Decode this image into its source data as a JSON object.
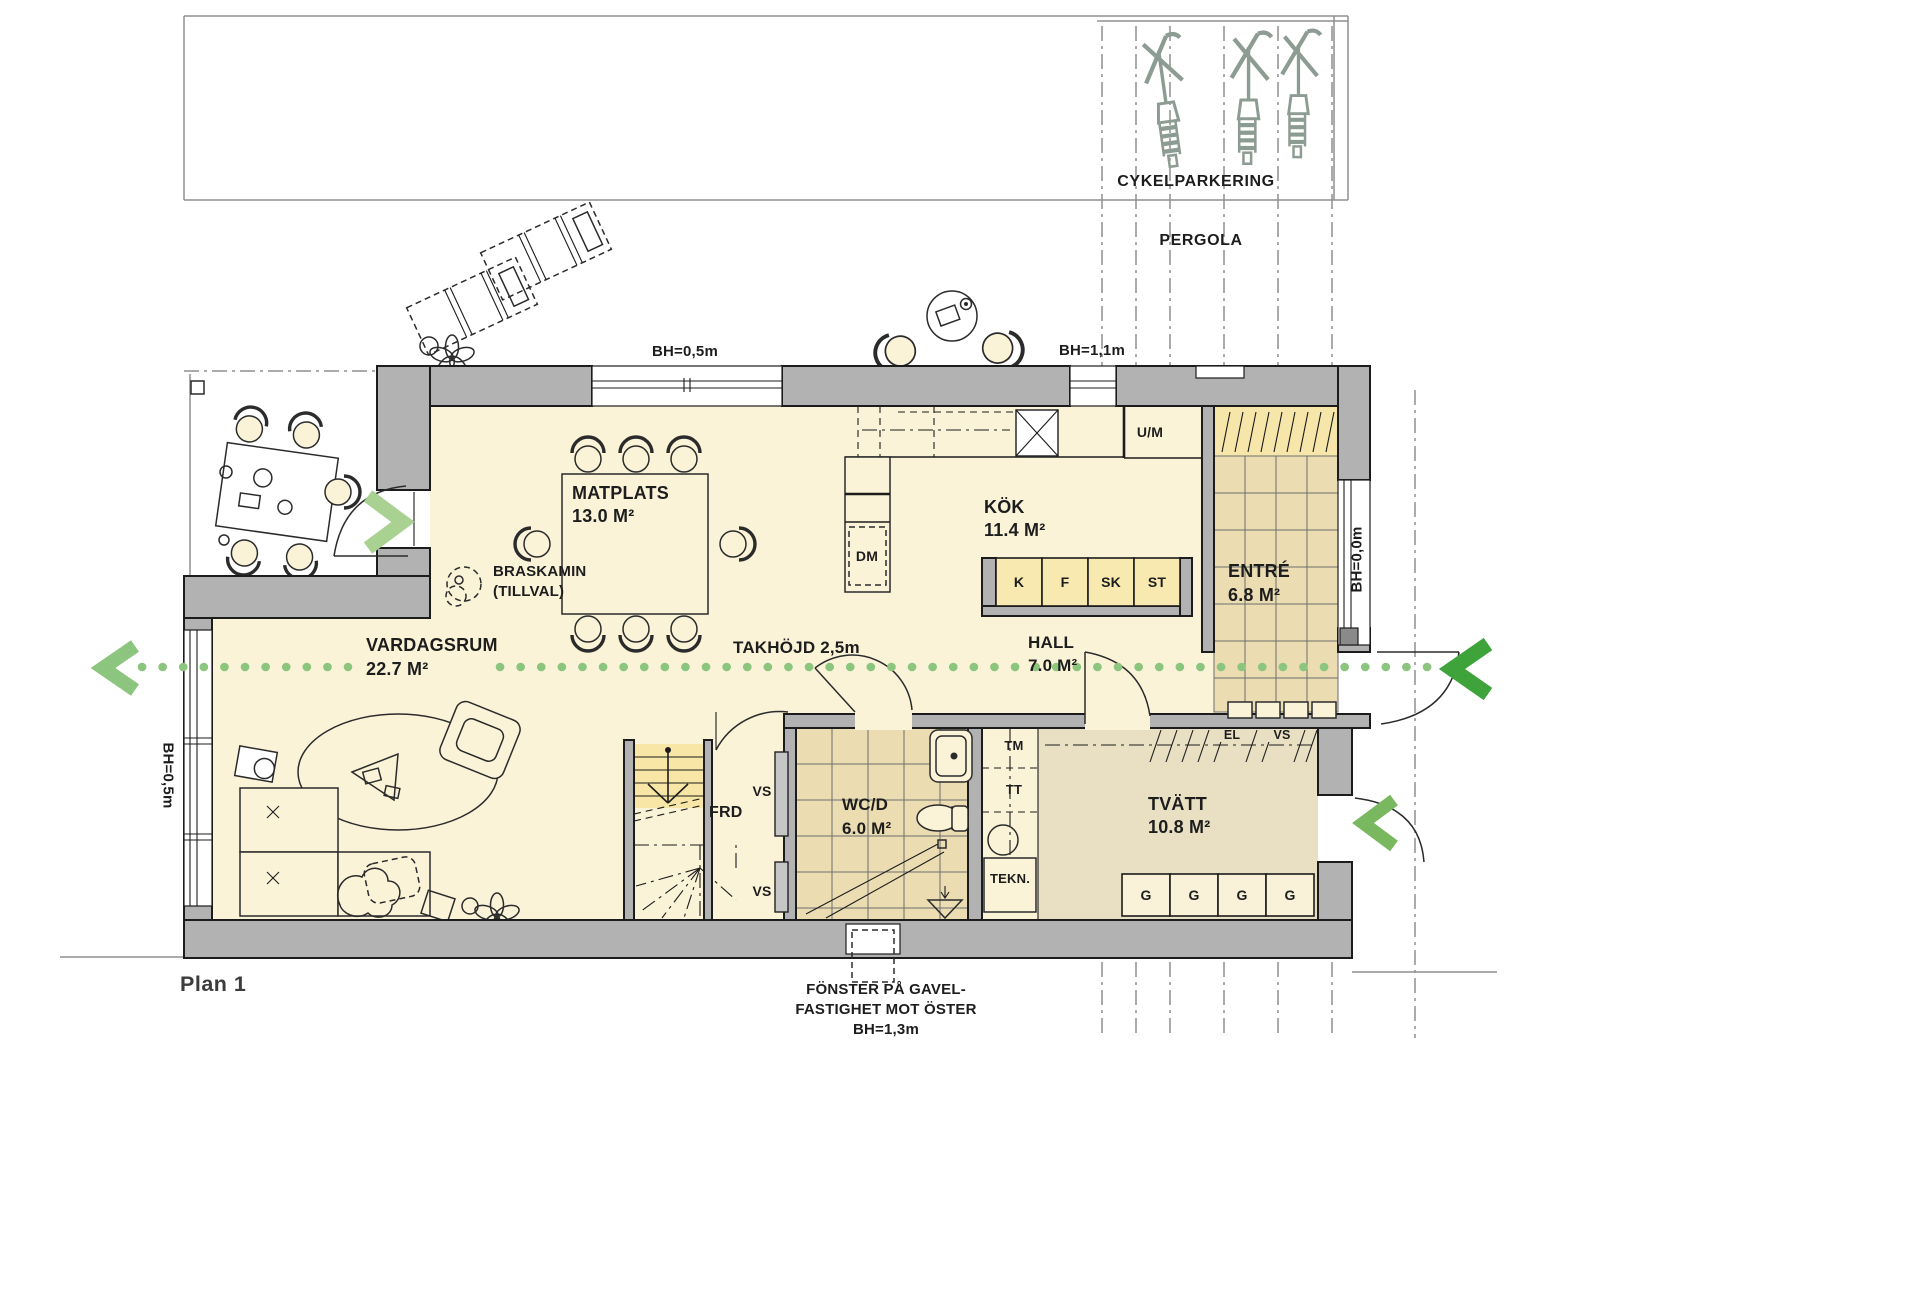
{
  "plan": {
    "title": "Plan 1"
  },
  "site": {
    "cykelparkering": "CYKELPARKERING",
    "pergola": "PERGOLA"
  },
  "section": {
    "label": "TAKHÖJD 2,5m"
  },
  "rooms": {
    "matplats": {
      "name": "MATPLATS",
      "area": "13.0 M²"
    },
    "kok": {
      "name": "KÖK",
      "area": "11.4 M²"
    },
    "entre": {
      "name": "ENTRÉ",
      "area": "6.8 M²"
    },
    "vardagsrum": {
      "name": "VARDAGSRUM",
      "area": "22.7 M²"
    },
    "hall": {
      "name": "HALL",
      "area": "7.0 M²"
    },
    "wcd": {
      "name": "WC/D",
      "area": "6.0 M²"
    },
    "tvatt": {
      "name": "TVÄTT",
      "area": "10.8 M²"
    },
    "frd": {
      "name": "FRD"
    }
  },
  "fixtures": {
    "um": "U/M",
    "dm": "DM",
    "kyl": "K",
    "frys": "F",
    "skap": "SK",
    "stad": "ST",
    "tm": "TM",
    "tt": "TT",
    "tekn": "TEKN.",
    "el": "EL",
    "vs": "VS",
    "g": "G",
    "braskamin": "BRASKAMIN",
    "tillval": "(TILLVAL)"
  },
  "dims": {
    "bh_top": "BH=0,5m",
    "bh_kitchen": "BH=1,1m",
    "bh_right": "BH=0,0m",
    "bh_left": "BH=0,5m"
  },
  "note": {
    "l1": "FÖNSTER PÅ GAVEL-",
    "l2": "FASTIGHET MOT ÖSTER",
    "l3": "BH=1,3m"
  },
  "colors": {
    "floor": "#faf3d8",
    "tiles": "#ebdcb2",
    "wall": "#b2b2b2",
    "cabinet": "#f8e9b0",
    "tvatt_floor": "#e9e0c4",
    "stair_highlight": "#f7e6a6",
    "section_green": "#8cc57d",
    "arrow_dark": "#3fa33c",
    "arrow_light": "#a8d192",
    "bike": "#8d9c92"
  }
}
